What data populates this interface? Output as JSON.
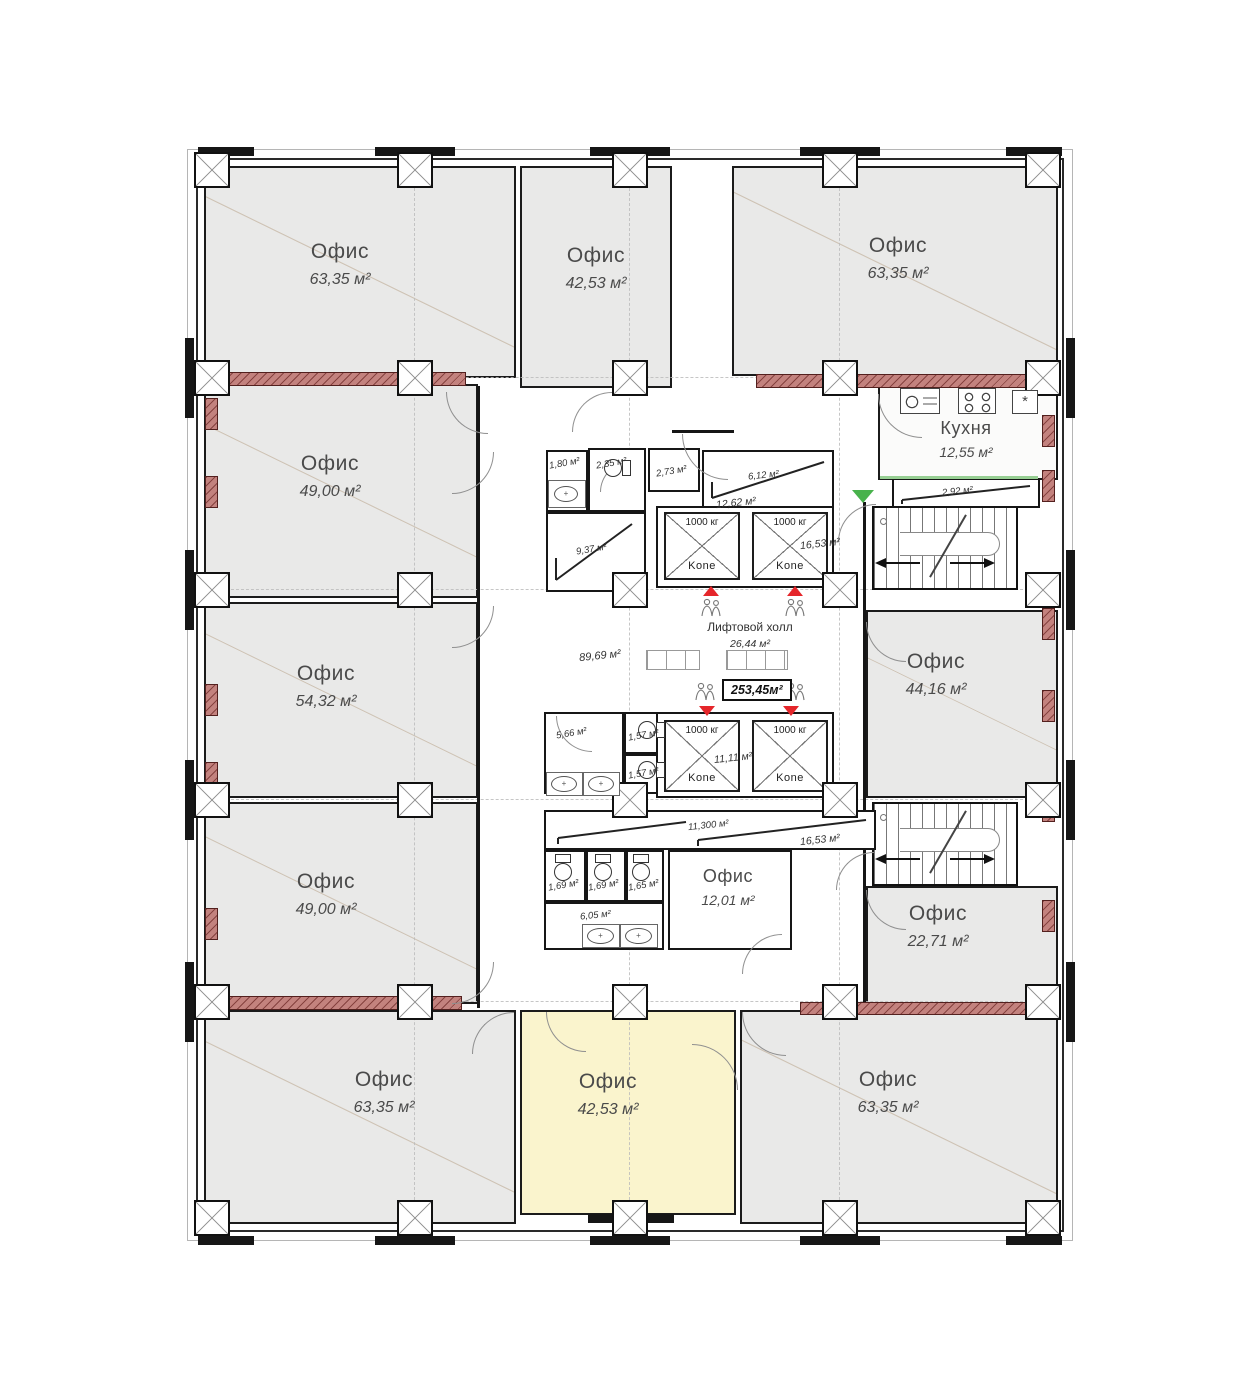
{
  "floor_plan": {
    "offices": [
      {
        "id": "top-left",
        "label": "Офис",
        "area": "63,35 м²",
        "highlighted": false
      },
      {
        "id": "top-center",
        "label": "Офис",
        "area": "42,53 м²",
        "highlighted": false
      },
      {
        "id": "top-right",
        "label": "Офис",
        "area": "63,35 м²",
        "highlighted": false
      },
      {
        "id": "left-upper",
        "label": "Офис",
        "area": "49,00 м²",
        "highlighted": false
      },
      {
        "id": "left-middle",
        "label": "Офис",
        "area": "54,32 м²",
        "highlighted": false
      },
      {
        "id": "left-lower",
        "label": "Офис",
        "area": "49,00 м²",
        "highlighted": false
      },
      {
        "id": "right-middle",
        "label": "Офис",
        "area": "44,16 м²",
        "highlighted": false
      },
      {
        "id": "right-lower",
        "label": "Офис",
        "area": "22,71 м²",
        "highlighted": false
      },
      {
        "id": "bottom-left",
        "label": "Офис",
        "area": "63,35 м²",
        "highlighted": false
      },
      {
        "id": "bottom-center",
        "label": "Офис",
        "area": "42,53 м²",
        "highlighted": true
      },
      {
        "id": "bottom-right",
        "label": "Офис",
        "area": "63,35 м²",
        "highlighted": false
      },
      {
        "id": "core-office",
        "label": "Офис",
        "area": "12,01 м²",
        "highlighted": false
      }
    ],
    "kitchen": {
      "label": "Кухня",
      "area": "12,55 м²"
    },
    "lift_hall": {
      "label": "Лифтовой холл",
      "area": "26,44 м²"
    },
    "areas": {
      "open_space": "89,69 м²",
      "floor_total": "253,45м²",
      "upper_lift_shaft": "12,62 м²",
      "lower_lift_shaft": "11,11 м²",
      "corridor": "11,300 м²",
      "kitchen_counter": "2,92 м²",
      "stairs_upper": "16,53 м²",
      "stairs_lower": "16,53 м²",
      "room_1": "1,80 м²",
      "room_2": "2,35 м²",
      "room_3": "2,73 м²",
      "room_4": "6,12 м²",
      "room_5": "9,37 м²",
      "room_6": "5,66 м²",
      "room_7": "1,57 м²",
      "room_8": "1,57 м²",
      "wc_stall_1": "1,69 м²",
      "wc_stall_2": "1,69 м²",
      "wc_stall_3": "1,65 м²",
      "washroom": "6,05 м²"
    },
    "elevators": {
      "capacity_label": "1000 кг",
      "brand": "Kone"
    },
    "colors": {
      "office_fill": "#e9e9e8",
      "highlight_fill": "#faf4cd",
      "red_wall": "#bd7672",
      "alert_red": "#e5262b",
      "entry_green": "#48b24c",
      "wall": "#1b1b1b"
    }
  }
}
